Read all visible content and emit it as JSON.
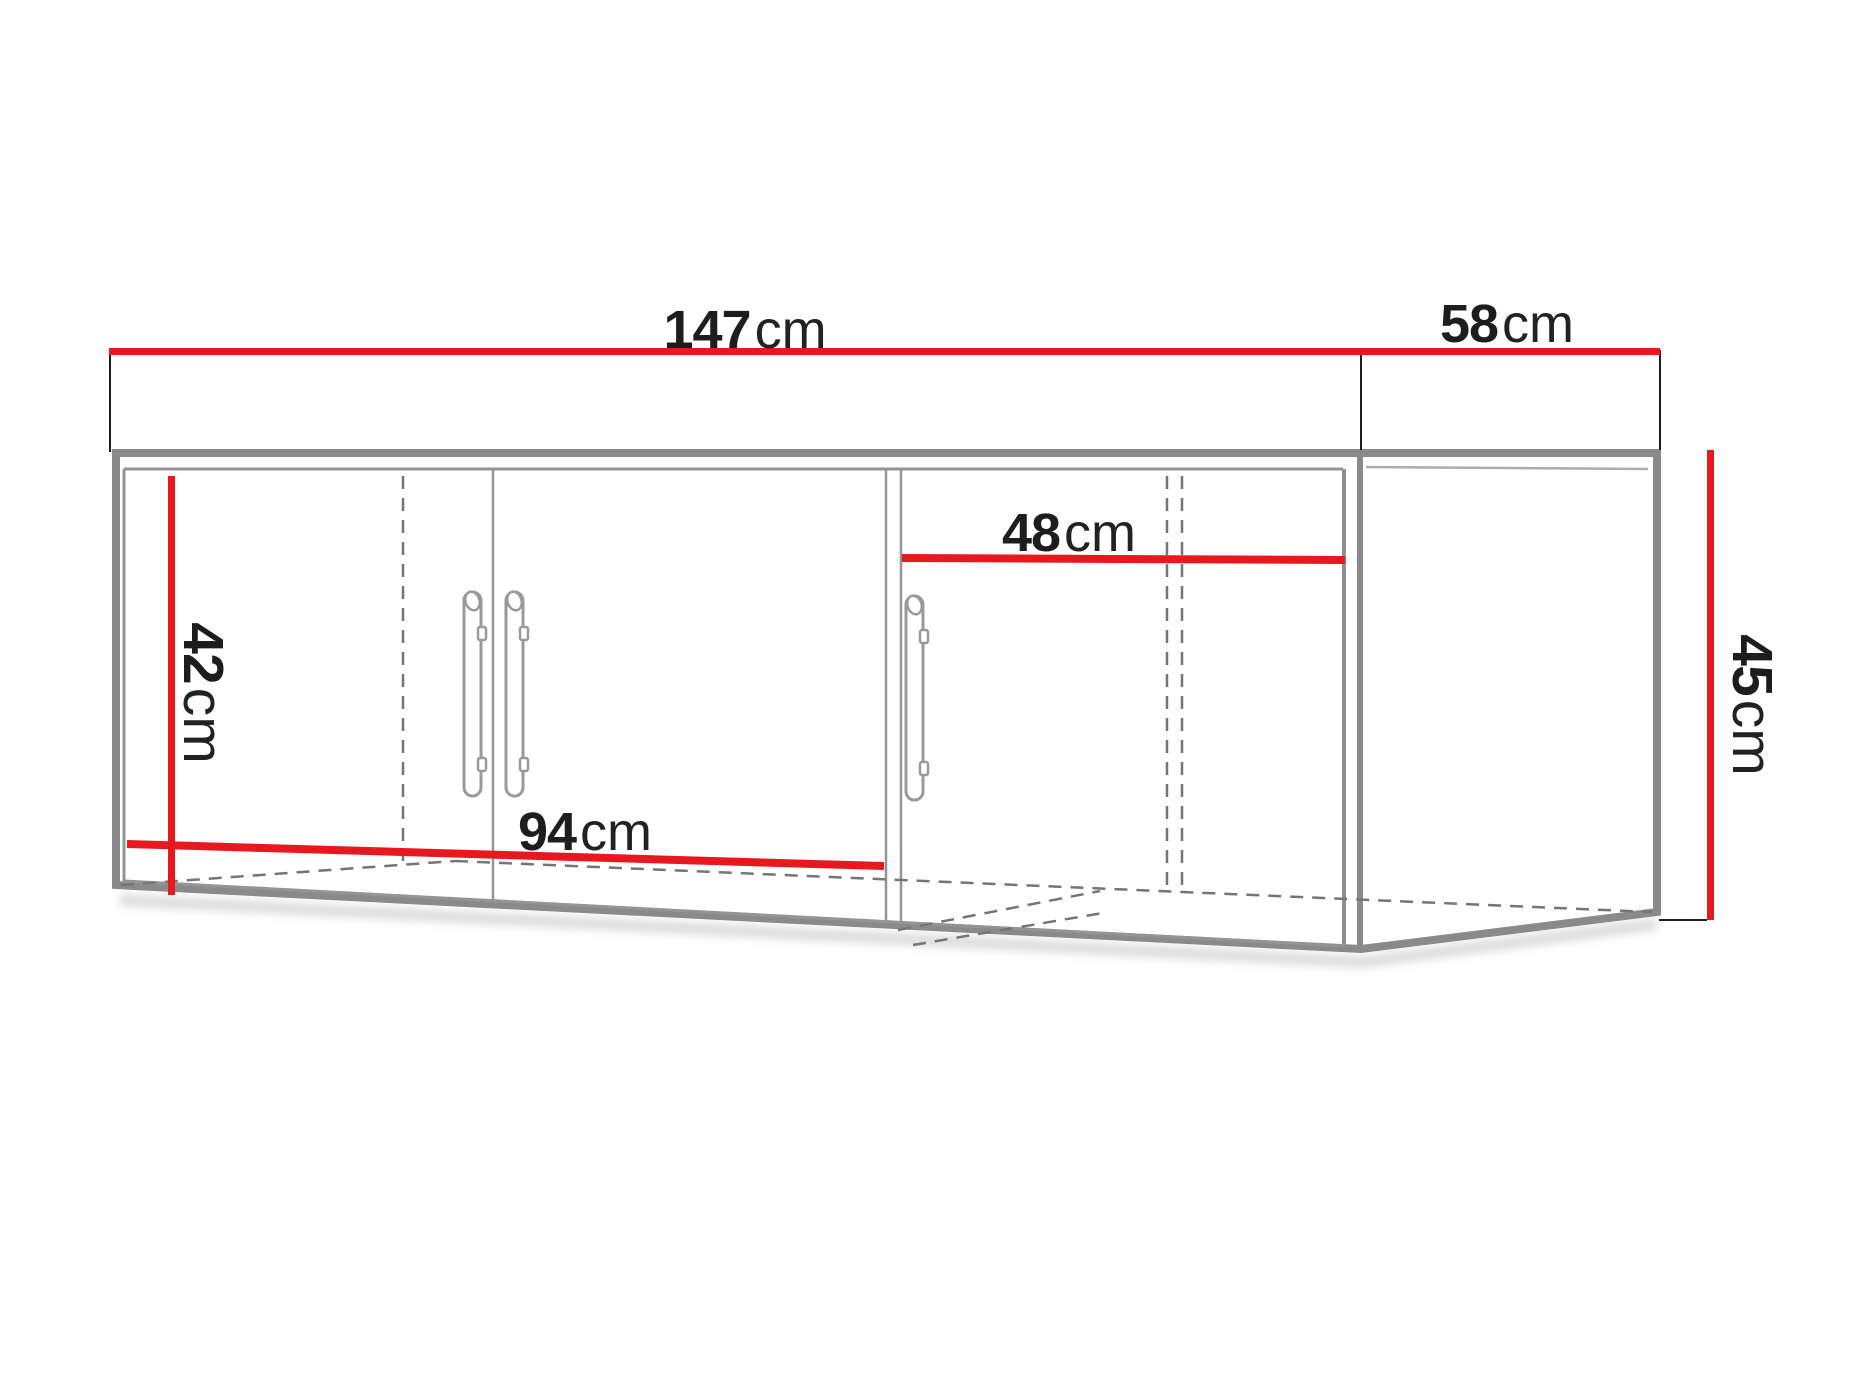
{
  "colors": {
    "dimension_line": "#e8191e",
    "cabinet_outline": "#8a8a8a",
    "inner_line": "#949494",
    "hidden_line": "#757575",
    "label_text": "#1d1d1b"
  },
  "dimensions": {
    "total_width": {
      "value": "147",
      "unit": "cm"
    },
    "side_depth": {
      "value": "58",
      "unit": "cm"
    },
    "right_door_width": {
      "value": "48",
      "unit": "cm"
    },
    "left_height": {
      "value": "42",
      "unit": "cm"
    },
    "right_height": {
      "value": "45",
      "unit": "cm"
    },
    "double_door_span": {
      "value": "94",
      "unit": "cm"
    }
  }
}
